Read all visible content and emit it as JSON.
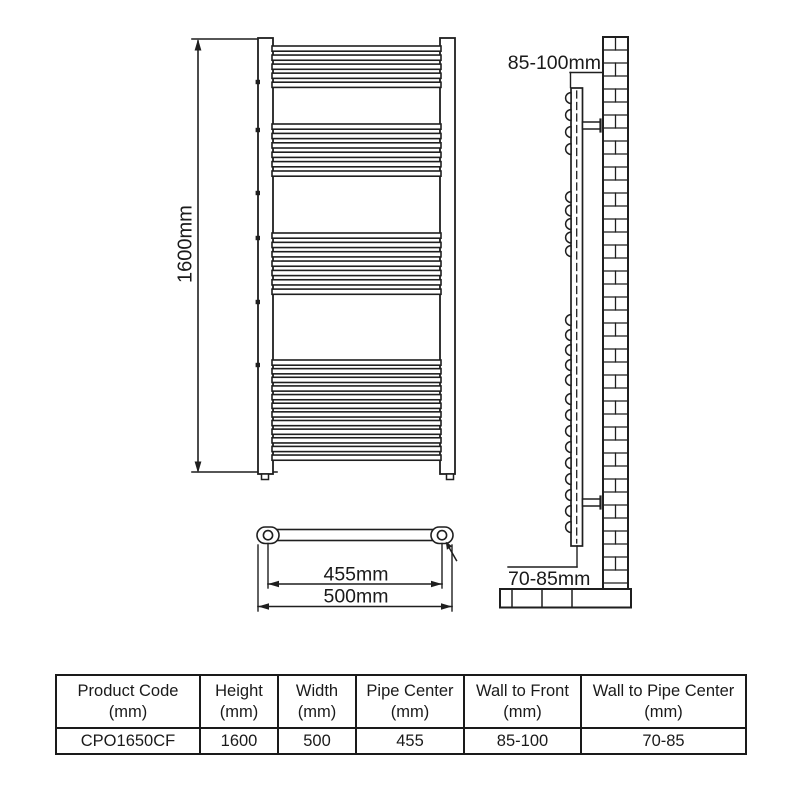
{
  "diagram": {
    "line_color": "#1f1f1f",
    "front_view": {
      "height_label": "1600mm"
    },
    "bottom_view": {
      "pipe_center_label": "455mm",
      "width_label": "500mm"
    },
    "side_view": {
      "wall_to_front_label": "85-100mm",
      "wall_to_pipe_label": "70-85mm"
    }
  },
  "spec_table": {
    "columns": [
      {
        "title": "Product Code",
        "unit": "(mm)"
      },
      {
        "title": "Height",
        "unit": "(mm)"
      },
      {
        "title": "Width",
        "unit": "(mm)"
      },
      {
        "title": "Pipe Center",
        "unit": "(mm)"
      },
      {
        "title": "Wall to Front",
        "unit": "(mm)"
      },
      {
        "title": "Wall to Pipe Center",
        "unit": "(mm)"
      }
    ],
    "row": [
      "CPO1650CF",
      "1600",
      "500",
      "455",
      "85-100",
      "70-85"
    ]
  }
}
